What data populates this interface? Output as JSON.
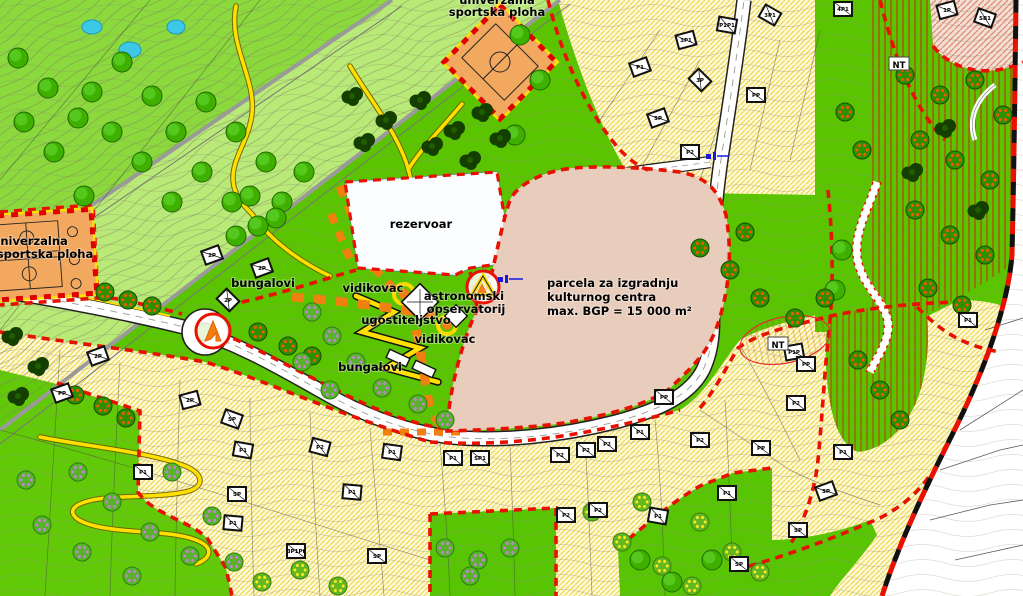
{
  "map": {
    "region_labels": [
      {
        "text": "univerzalna"
      },
      {
        "text": "sportska ploha"
      },
      {
        "text": "univerzalna"
      },
      {
        "text": "sportska ploha"
      },
      {
        "text": "rezervoar"
      },
      {
        "text": "bungalovi"
      },
      {
        "text": "vidikovac"
      },
      {
        "text": "astronomski"
      },
      {
        "text": "opservatorij"
      },
      {
        "text": "ugostiteljstvo"
      },
      {
        "text": "vidikovac"
      },
      {
        "text": "bungalovi"
      },
      {
        "text": "parcela za izgradnju"
      },
      {
        "text": "kulturnog centra"
      },
      {
        "text": "max. BGP = 15 000 m²"
      }
    ],
    "nt_markers": [
      {
        "text": "NT"
      },
      {
        "text": "NT"
      }
    ],
    "houses": [
      [
        640,
        67,
        -20,
        "P1"
      ],
      [
        686,
        40,
        -15,
        "3P1"
      ],
      [
        727,
        25,
        10,
        "P1P1"
      ],
      [
        770,
        15,
        30,
        "3P1"
      ],
      [
        843,
        9,
        0,
        "4P1"
      ],
      [
        947,
        10,
        -15,
        "1P"
      ],
      [
        985,
        18,
        20,
        "SB1"
      ],
      [
        700,
        80,
        45,
        "3P"
      ],
      [
        658,
        118,
        -20,
        "SP"
      ],
      [
        756,
        95,
        0,
        "PP"
      ],
      [
        690,
        152,
        0,
        "P2"
      ],
      [
        212,
        255,
        -20,
        "2P"
      ],
      [
        262,
        268,
        -20,
        "2P"
      ],
      [
        228,
        300,
        45,
        "2P"
      ],
      [
        62,
        393,
        -20,
        "PP"
      ],
      [
        98,
        356,
        -20,
        "2P"
      ],
      [
        143,
        472,
        0,
        "P1"
      ],
      [
        190,
        400,
        -15,
        "2P"
      ],
      [
        232,
        419,
        20,
        "SP"
      ],
      [
        243,
        450,
        10,
        "P1"
      ],
      [
        237,
        494,
        0,
        "SP"
      ],
      [
        233,
        523,
        5,
        "P1"
      ],
      [
        296,
        551,
        0,
        "3P1Pt"
      ],
      [
        320,
        447,
        15,
        "P2"
      ],
      [
        352,
        492,
        5,
        "P1"
      ],
      [
        377,
        556,
        0,
        "SP"
      ],
      [
        392,
        452,
        8,
        "P1"
      ],
      [
        453,
        458,
        0,
        "P1"
      ],
      [
        480,
        458,
        0,
        "SP1"
      ],
      [
        560,
        455,
        0,
        "P2"
      ],
      [
        586,
        450,
        0,
        "P2"
      ],
      [
        607,
        444,
        0,
        "P2"
      ],
      [
        566,
        515,
        0,
        "P2"
      ],
      [
        598,
        510,
        0,
        "P2"
      ],
      [
        664,
        397,
        0,
        "PP"
      ],
      [
        640,
        432,
        0,
        "P1"
      ],
      [
        658,
        516,
        10,
        "P1"
      ],
      [
        700,
        440,
        0,
        "P2"
      ],
      [
        727,
        493,
        0,
        "P1"
      ],
      [
        739,
        564,
        0,
        "SP"
      ],
      [
        794,
        352,
        -10,
        "P1P"
      ],
      [
        806,
        364,
        0,
        "PP"
      ],
      [
        796,
        403,
        0,
        "P2"
      ],
      [
        761,
        448,
        0,
        "PP"
      ],
      [
        826,
        491,
        -20,
        "SP"
      ],
      [
        843,
        452,
        0,
        "P1"
      ],
      [
        798,
        530,
        0,
        "SP"
      ],
      [
        968,
        320,
        0,
        "P1"
      ]
    ],
    "colors": {
      "base_green": "#5ac400",
      "park_green_light": "#b9ea77",
      "park_green_mid": "#8bd93c",
      "residential_cream": "#fdf9da",
      "residential_hatch": "#eed84e",
      "parcel_pink": "#e9cdbc",
      "parcel_hatch": "#bf6a52",
      "reservoir_hatch": "#4b82e0",
      "sports_orange": "#f2a85f",
      "route_orange": "#f08010",
      "zone_boundary_red": "#e81000",
      "municipal_boundary_black": "#111111",
      "road_white": "#ffffff",
      "path_yellow": "#ffe000"
    }
  }
}
